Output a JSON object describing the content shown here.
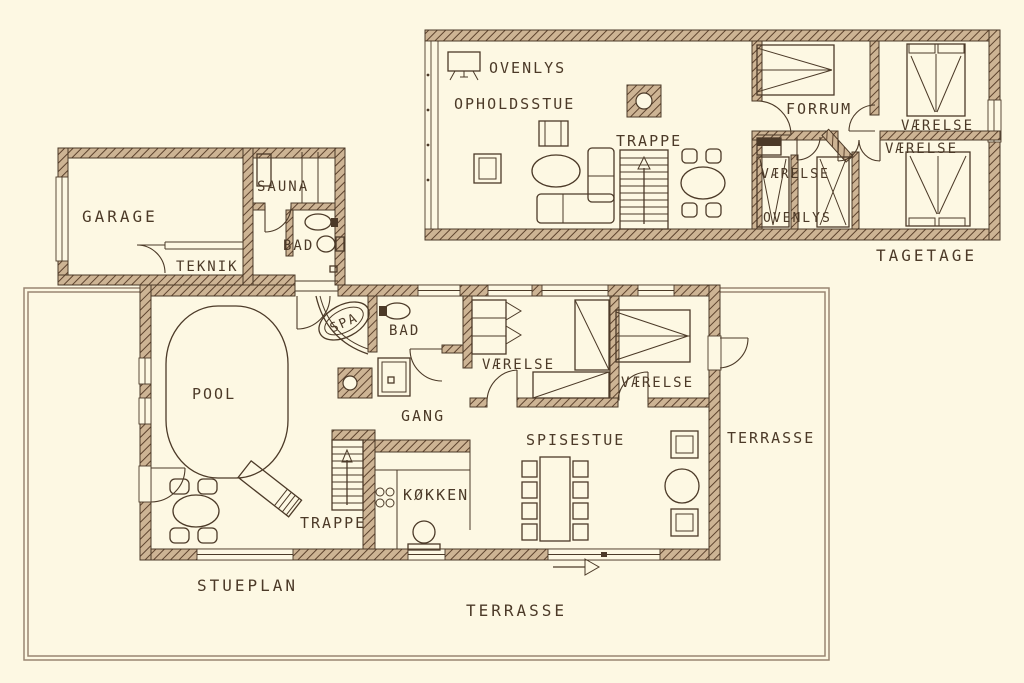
{
  "palette": {
    "background": "#fdf8e3",
    "ink": "#4c3a28",
    "wall_hatch_bg": "#cdb494",
    "wall_hatch_line": "#5d432e",
    "terrace_line": "#9a8672"
  },
  "upper_floor": {
    "plan_label": "TAGETAGE",
    "labels": {
      "ovenlys_top": "OVENLYS",
      "opholdsstue": "OPHOLDSSTUE",
      "trappe": "TRAPPE",
      "forrum": "FORRUM",
      "vaerelse_ne": "VÆRELSE",
      "vaerelse_se": "VÆRELSE",
      "vaerelse_mid": "VÆRELSE",
      "ovenlys_mid": "OVENLYS"
    }
  },
  "ground_floor": {
    "plan_label": "STUEPLAN",
    "labels": {
      "garage": "GARAGE",
      "teknik": "TEKNIK",
      "sauna": "SAUNA",
      "bad_garage": "BAD",
      "spa": "SPA",
      "pool": "POOL",
      "bad": "BAD",
      "gang": "GANG",
      "vaerelse_1": "VÆRELSE",
      "vaerelse_2": "VÆRELSE",
      "trappe": "TRAPPE",
      "koekken": "KØKKEN",
      "spisestue": "SPISESTUE",
      "terrasse_right": "TERRASSE",
      "terrasse_bottom": "TERRASSE"
    }
  }
}
